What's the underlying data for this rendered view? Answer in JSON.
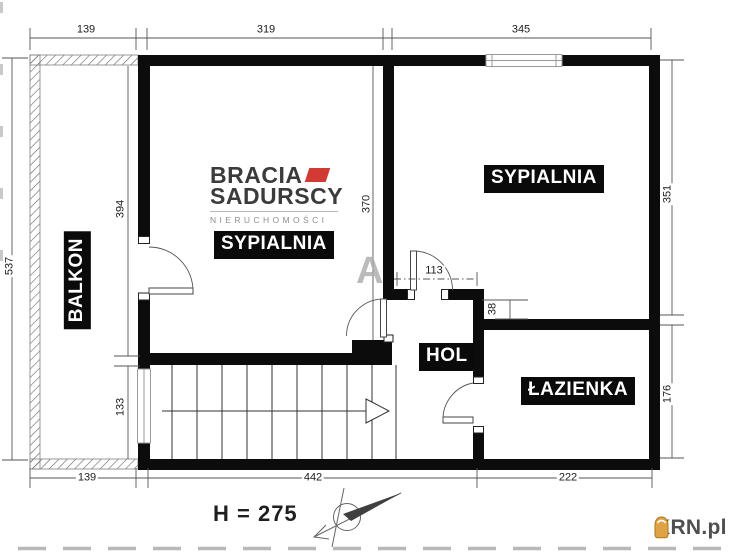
{
  "rooms": {
    "balkon": "BALKON",
    "sypialnia_left": "SYPIALNIA",
    "sypialnia_right": "SYPIALNIA",
    "hol": "HOL",
    "lazienka": "ŁAZIENKA"
  },
  "dimensions": {
    "top_balcony": "139",
    "top_bedroom_left": "319",
    "top_bedroom_right": "345",
    "left_total": "537",
    "left_bedroom": "394",
    "left_stairs": "133",
    "bedroom_left_depth": "370",
    "hall_door": "113",
    "wall_offset": "38",
    "right_bedroom": "351",
    "right_bathroom": "176",
    "bottom_balcony": "139",
    "bottom_main": "442",
    "bottom_bathroom": "222"
  },
  "notes": {
    "ceiling_height": "H = 275",
    "watermark_letter": "A"
  },
  "branding": {
    "agency_line1": "BRACIA",
    "agency_line2": "SADURSCY",
    "agency_line3": "NIERUCHOMOŚCI",
    "agency_accent_color": "#d23b34",
    "portal_name": "KRN.pl",
    "portal_icon_color": "#dfa245"
  }
}
